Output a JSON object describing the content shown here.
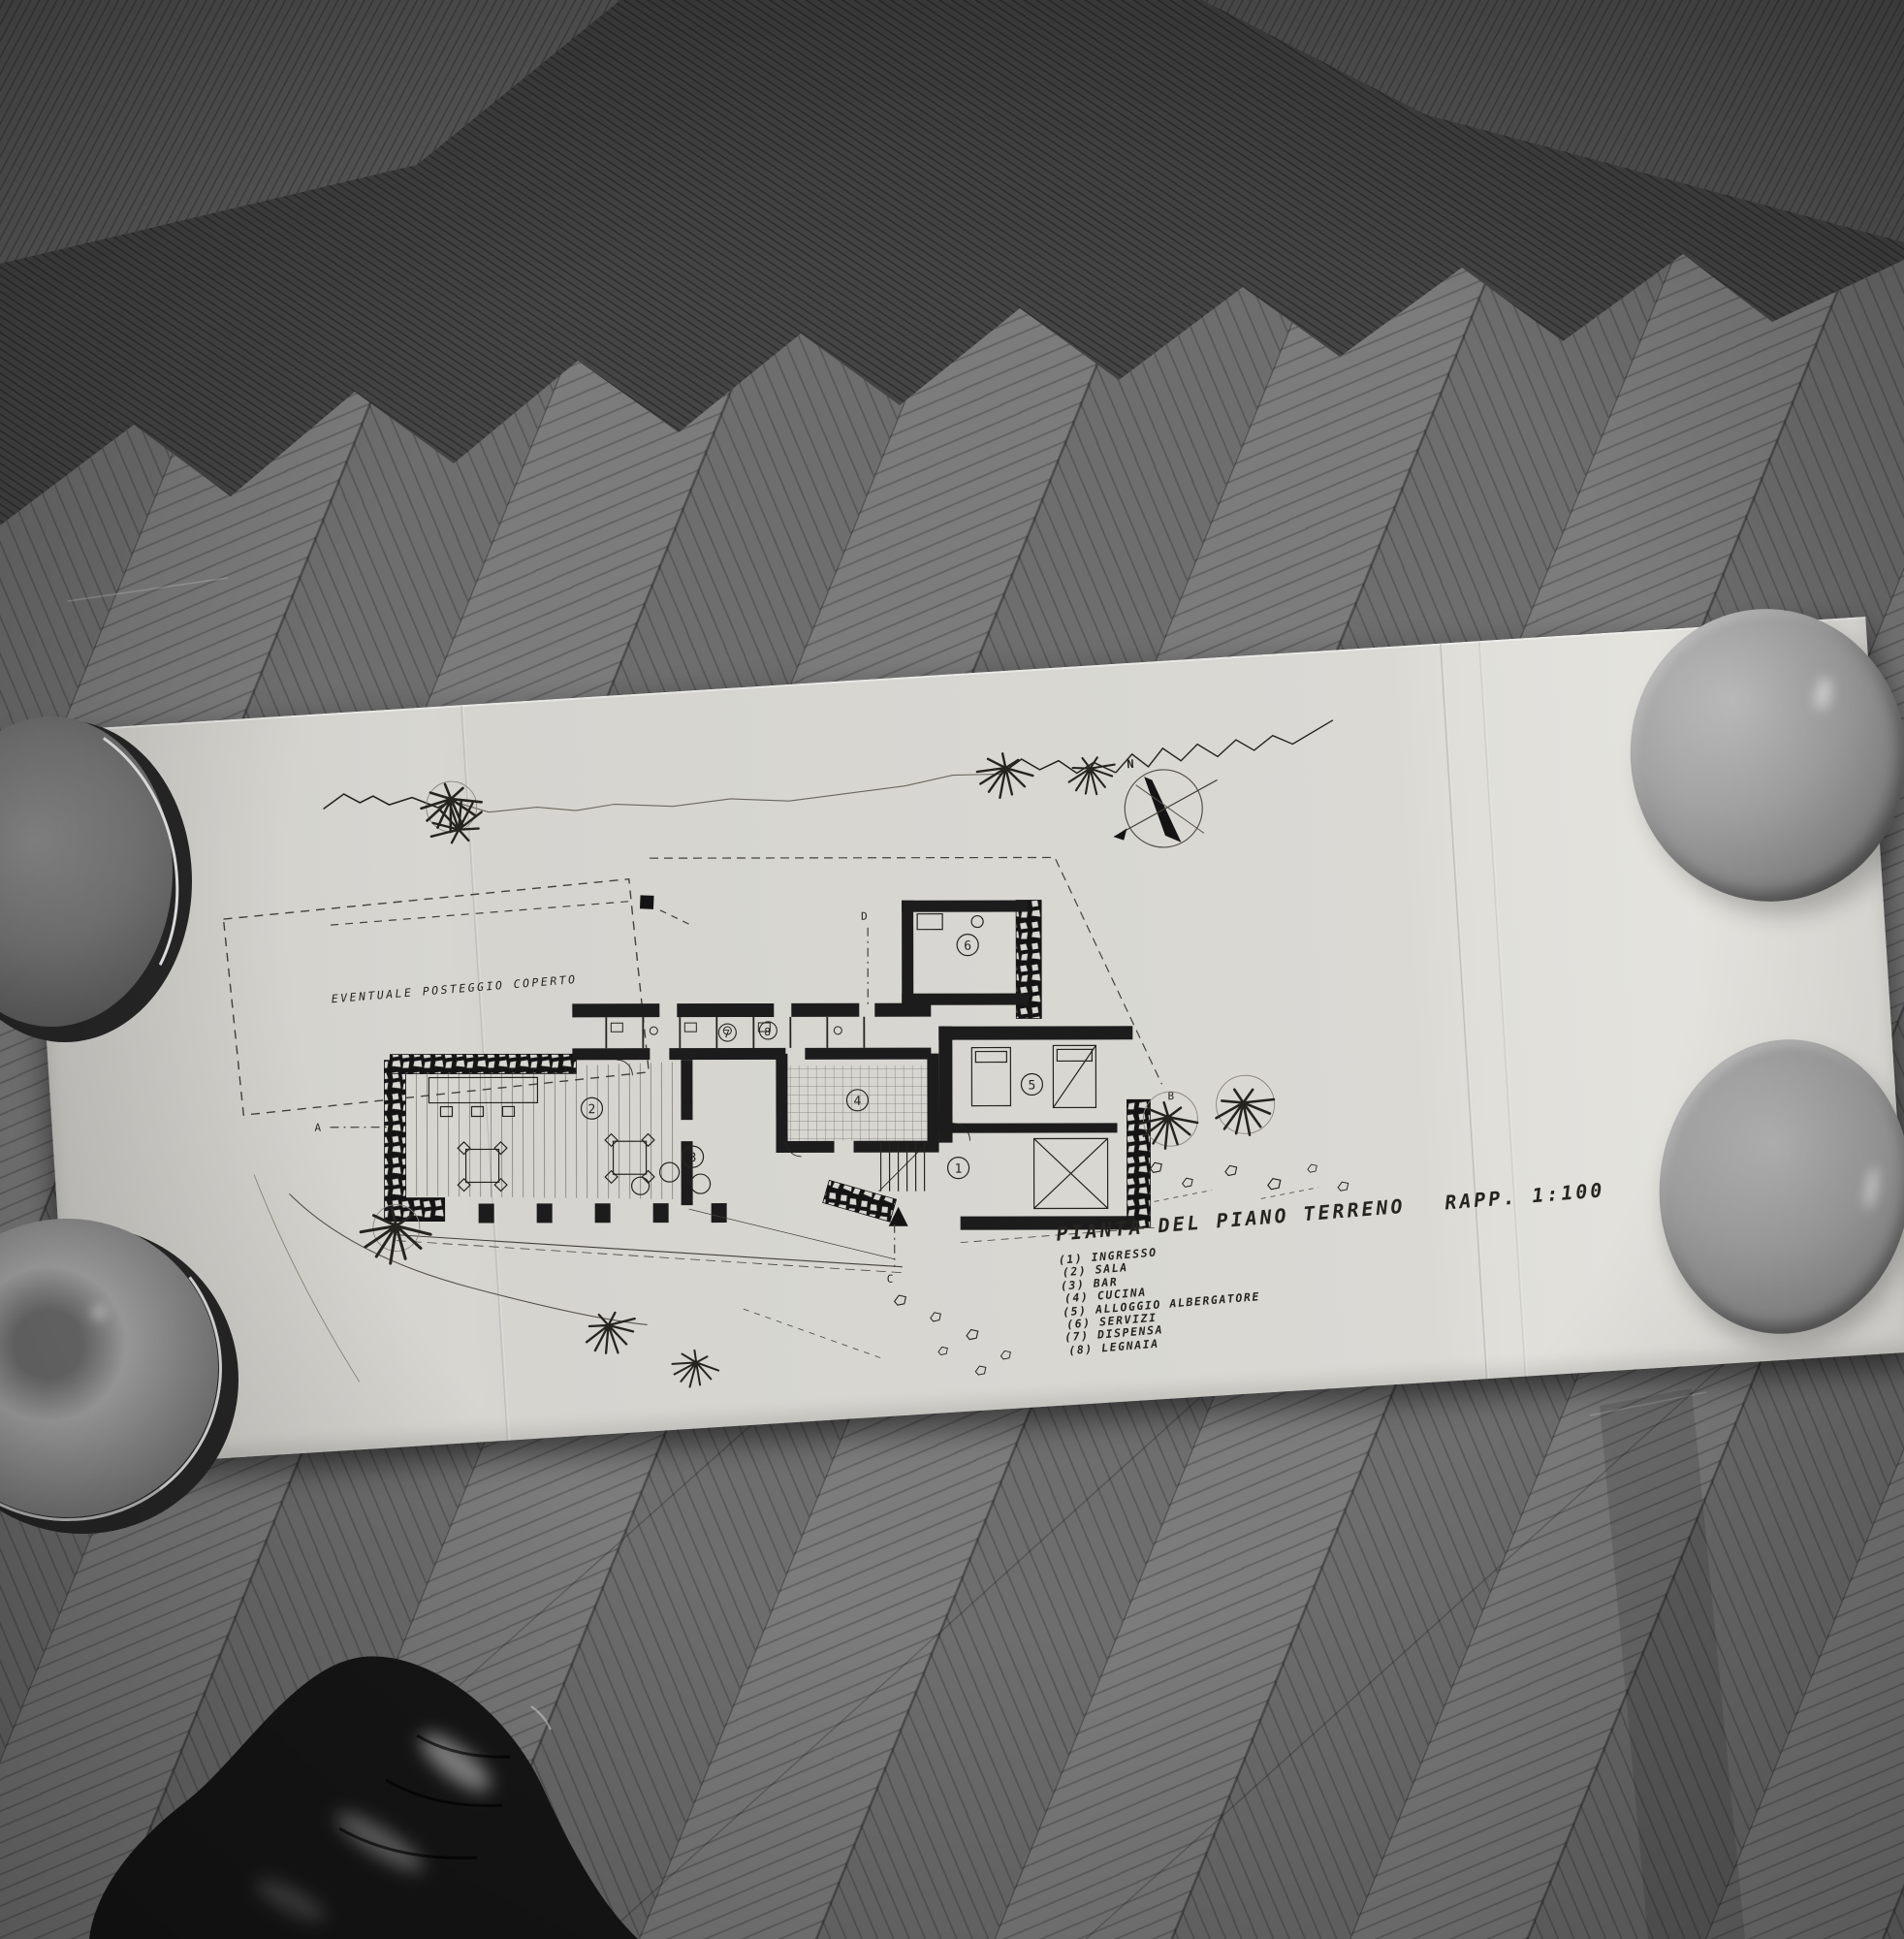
{
  "drawing": {
    "title": "PIANTA DEL PIANO TERRENO",
    "scale": "RAPP. 1:100",
    "site_note": "EVENTUALE POSTEGGIO COPERTO",
    "compass_north": "N",
    "section_markers": [
      "A",
      "B",
      "C",
      "D"
    ],
    "rooms": [
      {
        "num": "1",
        "legend_no": "(1)",
        "name": "INGRESSO"
      },
      {
        "num": "2",
        "legend_no": "(2)",
        "name": "SALA"
      },
      {
        "num": "3",
        "legend_no": "(3)",
        "name": "BAR"
      },
      {
        "num": "4",
        "legend_no": "(4)",
        "name": "CUCINA"
      },
      {
        "num": "5",
        "legend_no": "(5)",
        "name": "ALLOGGIO ALBERGATORE"
      },
      {
        "num": "6",
        "legend_no": "(6)",
        "name": "SERVIZI"
      },
      {
        "num": "7",
        "legend_no": "(7)",
        "name": "DISPENSA"
      },
      {
        "num": "8",
        "legend_no": "(8)",
        "name": "LEGNAIA"
      }
    ],
    "colors": {
      "paper": "#d9d8d3",
      "ink": "#26241f",
      "floor": "#6f6f6f",
      "floor_dark": "#454545"
    }
  }
}
